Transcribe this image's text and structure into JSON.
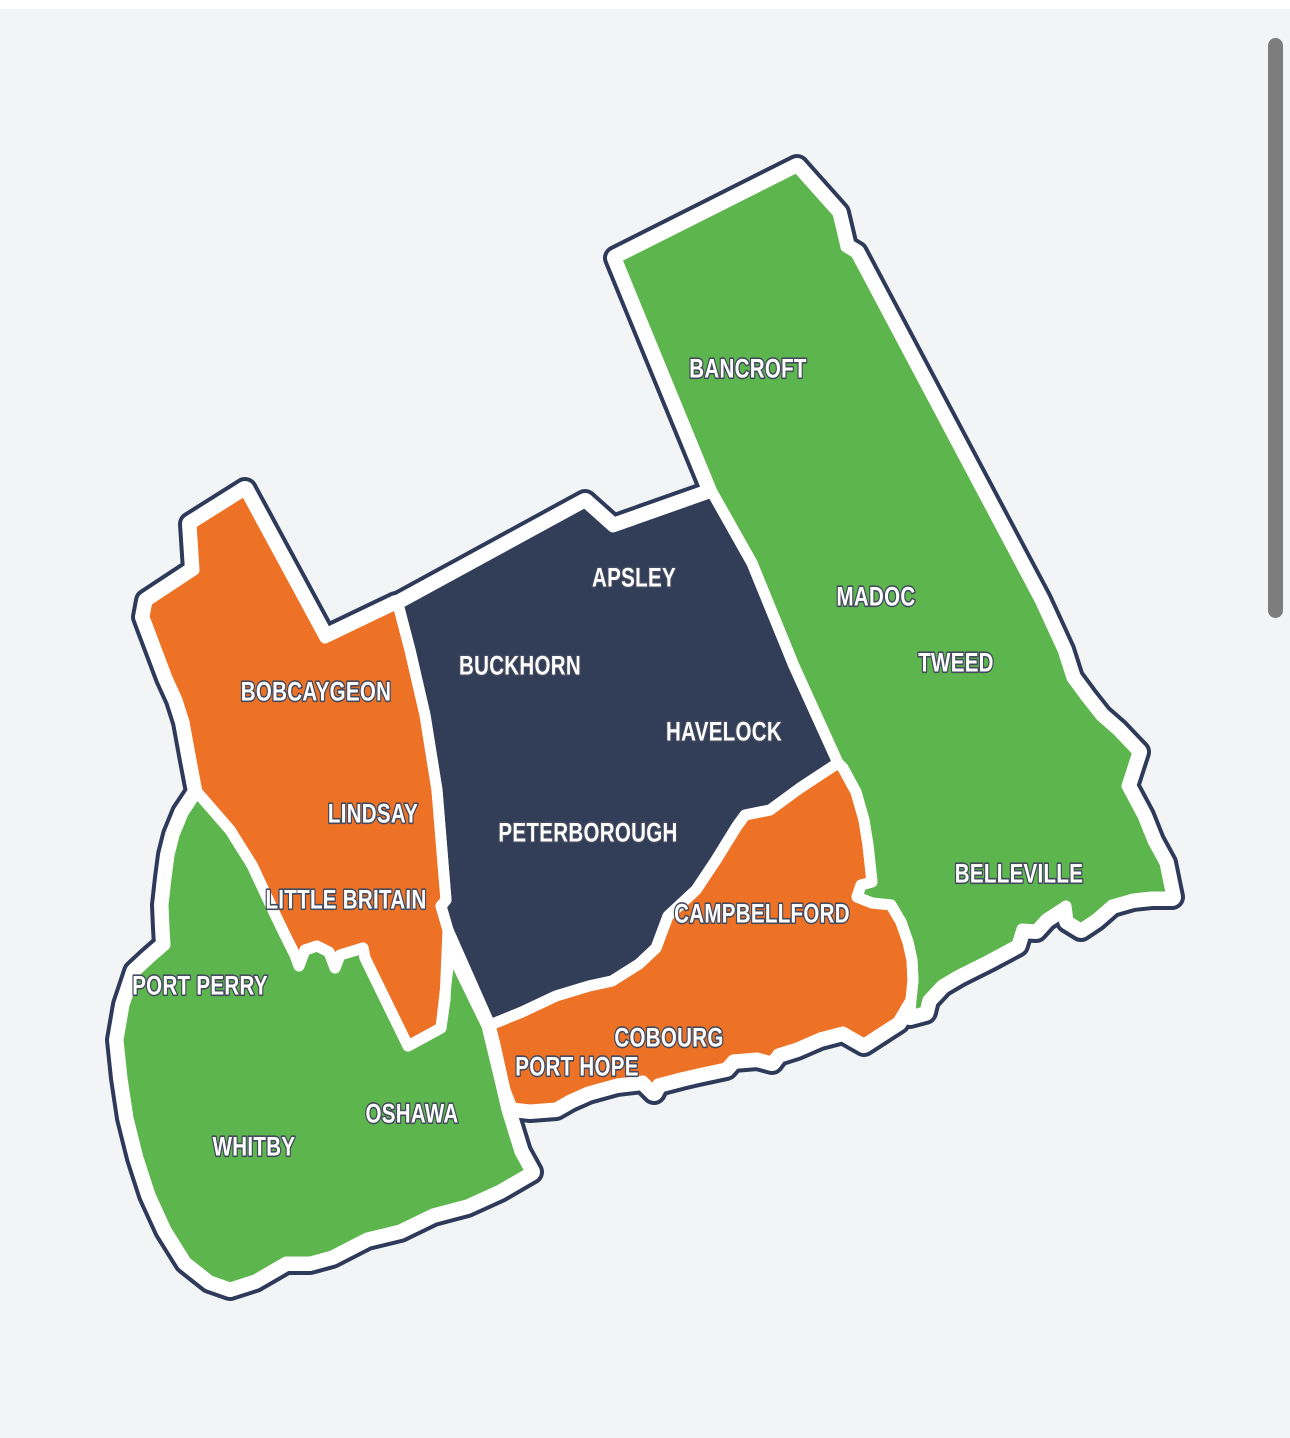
{
  "page": {
    "background": "#f3f4f5",
    "top_strip_color": "#ffffff"
  },
  "map": {
    "colors": {
      "green": "#5cb54d",
      "orange": "#ed7226",
      "navy": "#323d58",
      "outline": "#2e3a59",
      "gap": "#ffffff",
      "label_fill": "#ffffff",
      "label_outline": "#434a5e"
    },
    "regions": [
      {
        "id": "northeast-strip",
        "color": "green",
        "labels": [
          "BANCROFT",
          "MADOC",
          "TWEED",
          "BELLEVILLE"
        ]
      },
      {
        "id": "central-block",
        "color": "navy",
        "labels": [
          "APSLEY",
          "BUCKHORN",
          "HAVELOCK",
          "PETERBOROUGH"
        ]
      },
      {
        "id": "west-block",
        "color": "orange",
        "labels": [
          "BOBCAYGEON",
          "LINDSAY",
          "LITTLE BRITAIN"
        ]
      },
      {
        "id": "southwest-block",
        "color": "green",
        "labels": [
          "PORT PERRY",
          "OSHAWA",
          "WHITBY"
        ]
      },
      {
        "id": "south-shore",
        "color": "orange",
        "labels": [
          "CAMPBELLFORD",
          "COBOURG",
          "PORT HOPE"
        ]
      }
    ],
    "labels": [
      {
        "slug": "bancroft",
        "text": "BANCROFT",
        "x": 748,
        "y": 369
      },
      {
        "slug": "madoc",
        "text": "MADOC",
        "x": 876,
        "y": 597
      },
      {
        "slug": "tweed",
        "text": "TWEED",
        "x": 956,
        "y": 663
      },
      {
        "slug": "belleville",
        "text": "BELLEVILLE",
        "x": 1019,
        "y": 874
      },
      {
        "slug": "apsley",
        "text": "APSLEY",
        "x": 634,
        "y": 578
      },
      {
        "slug": "buckhorn",
        "text": "BUCKHORN",
        "x": 520,
        "y": 666
      },
      {
        "slug": "havelock",
        "text": "HAVELOCK",
        "x": 724,
        "y": 732
      },
      {
        "slug": "peterborough",
        "text": "PETERBOROUGH",
        "x": 588,
        "y": 833
      },
      {
        "slug": "bobcaygeon",
        "text": "BOBCAYGEON",
        "x": 316,
        "y": 692
      },
      {
        "slug": "lindsay",
        "text": "LINDSAY",
        "x": 373,
        "y": 814
      },
      {
        "slug": "little-britain",
        "text": "LITTLE BRITAIN",
        "x": 346,
        "y": 900
      },
      {
        "slug": "port-perry",
        "text": "PORT PERRY",
        "x": 200,
        "y": 986
      },
      {
        "slug": "oshawa",
        "text": "OSHAWA",
        "x": 412,
        "y": 1114
      },
      {
        "slug": "whitby",
        "text": "WHITBY",
        "x": 254,
        "y": 1147
      },
      {
        "slug": "campbellford",
        "text": "CAMPBELLFORD",
        "x": 762,
        "y": 914
      },
      {
        "slug": "cobourg",
        "text": "COBOURG",
        "x": 669,
        "y": 1038
      },
      {
        "slug": "port-hope",
        "text": "PORT HOPE",
        "x": 577,
        "y": 1067
      }
    ]
  },
  "scrollbar": {
    "color": "#7d7d7d"
  }
}
